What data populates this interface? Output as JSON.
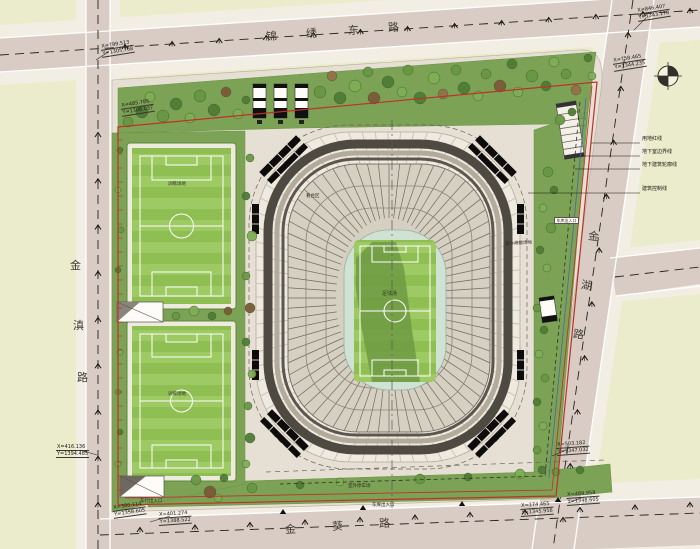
{
  "roads": {
    "top": {
      "name": "锦绣东路",
      "chars": [
        "锦",
        "绣",
        "东",
        "路"
      ]
    },
    "left": {
      "name": "金滇路",
      "chars": [
        "金",
        "滇",
        "路"
      ]
    },
    "right": {
      "name": "金湖路",
      "chars": [
        "金",
        "湖",
        "路"
      ]
    },
    "bottom": {
      "name": "金葵路",
      "chars": [
        "金",
        "葵",
        "路"
      ]
    }
  },
  "callouts": {
    "items": [
      {
        "label": "用地红线"
      },
      {
        "label": "地下室边界线"
      },
      {
        "label": "地下建筑轮廓线"
      },
      {
        "label": "建筑控制线"
      }
    ]
  },
  "coordinates": [
    {
      "x": "X=799.513",
      "y": "Y=1305.768"
    },
    {
      "x": "X=485.785",
      "y": "Y=1306.037"
    },
    {
      "x": "X=846.407",
      "y": "Y=1343.170"
    },
    {
      "x": "X=758.465",
      "y": "Y=1344.235"
    },
    {
      "x": "X=416.136",
      "y": "Y=1394.485"
    },
    {
      "x": "X=380.114",
      "y": "Y=1358.605"
    },
    {
      "x": "X=401.274",
      "y": "Y=1388.522"
    },
    {
      "x": "X=174.465",
      "y": "Y=1345.956"
    },
    {
      "x": "X=489.958",
      "y": "Y=1348.605"
    },
    {
      "x": "X=503.182",
      "y": "Y=1347.032"
    }
  ],
  "site_labels": {
    "stand": "看台区",
    "pitch": "足球场",
    "field_a": "训练场地",
    "field_b": "训练场地",
    "parking": "室外停车场",
    "garage_bottom": "车库出入口",
    "vehicle_entrance": "车行出入口",
    "garage_right": "车库出入口",
    "evacuation": "室外疏散场地"
  },
  "compass": {
    "icon": "north-arrow-icon"
  },
  "colors": {
    "block": "#ebeccc",
    "road": "#d8ccc4",
    "sidewalk": "#f3eee4",
    "parcel": "#e6dfd4",
    "green": "#7ca355",
    "turf": "#8fbf53",
    "mint": "#cfe2d4",
    "red_line": "#c03028",
    "blue_line": "#4a66a8",
    "roof_dark": "#4e4a42"
  }
}
